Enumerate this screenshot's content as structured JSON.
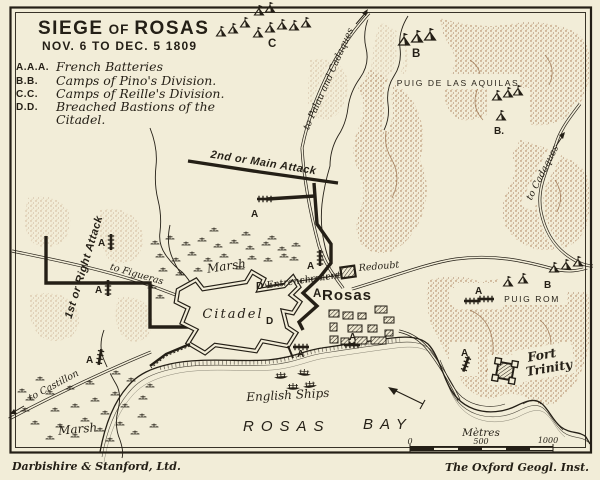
{
  "title": {
    "word1": "SIEGE",
    "word2": "OF",
    "word3": "ROSAS",
    "dates": "NOV. 6 TO DEC. 5 1809"
  },
  "legend": {
    "items": [
      {
        "key": "A.A.A.",
        "label": "French Batteries"
      },
      {
        "key": "B.B.",
        "label": "Camps of Pino's Division."
      },
      {
        "key": "C.C.",
        "label": "Camps of Reille's Division."
      },
      {
        "key": "D.D.",
        "label": "Breached Bastions of the",
        "label2": "Citadel."
      }
    ]
  },
  "places": {
    "puig_aquilas": "PUIG DE LAS AQUILAS",
    "puig_rom": "PUIG ROM",
    "fort_trinity_1": "Fort",
    "fort_trinity_2": "Trinity",
    "rosas": "Rosas",
    "citadel": "Citadel",
    "marsh_north": "Marsh",
    "marsh_south": "Marsh",
    "redoubt": "Redoubt",
    "entrenchement": "Entrenchement",
    "english_ships": "English Ships",
    "bay_word1": "ROSAS",
    "bay_word2": "BAY"
  },
  "attacks": {
    "main": "2nd or Main Attack",
    "right": "1st or Right Attack"
  },
  "roads": {
    "palau": "to Palau and Cadaques",
    "cadaques": "to Cadaques",
    "figueras": "to Figueras",
    "castillon": "to Castillon"
  },
  "markers": {
    "battery": "A",
    "camp_b": "B",
    "camp_b_dot": "B.",
    "camp_c": "C",
    "breach": "D"
  },
  "scale": {
    "unit": "Mètres",
    "zero": "0",
    "mid": "500",
    "end": "1000"
  },
  "credits": {
    "left": "Darbishire & Stanford, Ltd.",
    "right": "The Oxford Geogl. Inst."
  },
  "colors": {
    "paper": "#f2edd8",
    "ink": "#241f16",
    "hill": "#a4724a"
  }
}
